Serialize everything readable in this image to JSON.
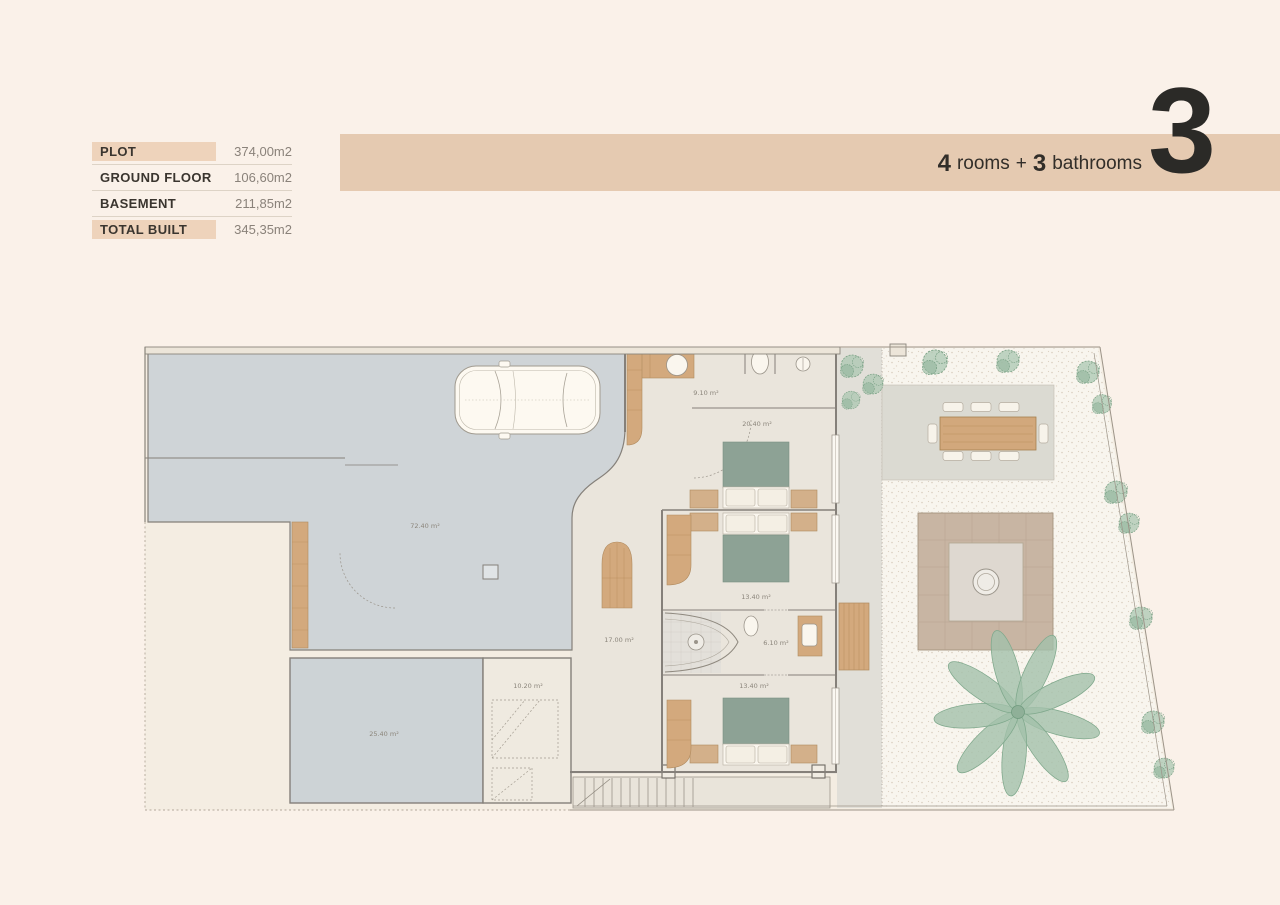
{
  "stats": {
    "rows": [
      {
        "label": "PLOT",
        "value": "374,00m2"
      },
      {
        "label": "GROUND FLOOR",
        "value": "106,60m2"
      },
      {
        "label": "BASEMENT",
        "value": "211,85m2"
      },
      {
        "label": "TOTAL BUILT",
        "value": "345,35m2"
      }
    ]
  },
  "header": {
    "rooms_count": "4",
    "rooms_word": "rooms",
    "plus": "+",
    "bathrooms_count": "3",
    "bathrooms_word": "bathrooms",
    "plan_number": "3"
  },
  "plan": {
    "rooms": [
      {
        "name": "driveway-garage",
        "area": "72.40 m²"
      },
      {
        "name": "bathroom-1",
        "area": "9.10 m²"
      },
      {
        "name": "bedroom-1",
        "area": "20.40 m²"
      },
      {
        "name": "bedroom-2",
        "area": "13.40 m²"
      },
      {
        "name": "bathroom-2",
        "area": "6.10 m²"
      },
      {
        "name": "bedroom-3",
        "area": "13.40 m²"
      },
      {
        "name": "hall",
        "area": "17.00 m²"
      },
      {
        "name": "stairs-room",
        "area": "10.20 m²"
      },
      {
        "name": "basement-room",
        "area": "25.40 m²"
      }
    ]
  },
  "colors": {
    "page_background": "#faf1e9",
    "band": "#e5cab1",
    "table_highlight": "#eed3bb",
    "driveway_gray": "#cfd4d7",
    "wood": "#d3a97d",
    "bed_green": "#8da295",
    "bush_green": "#abc7b2",
    "gravel": "#f8f5ee"
  }
}
